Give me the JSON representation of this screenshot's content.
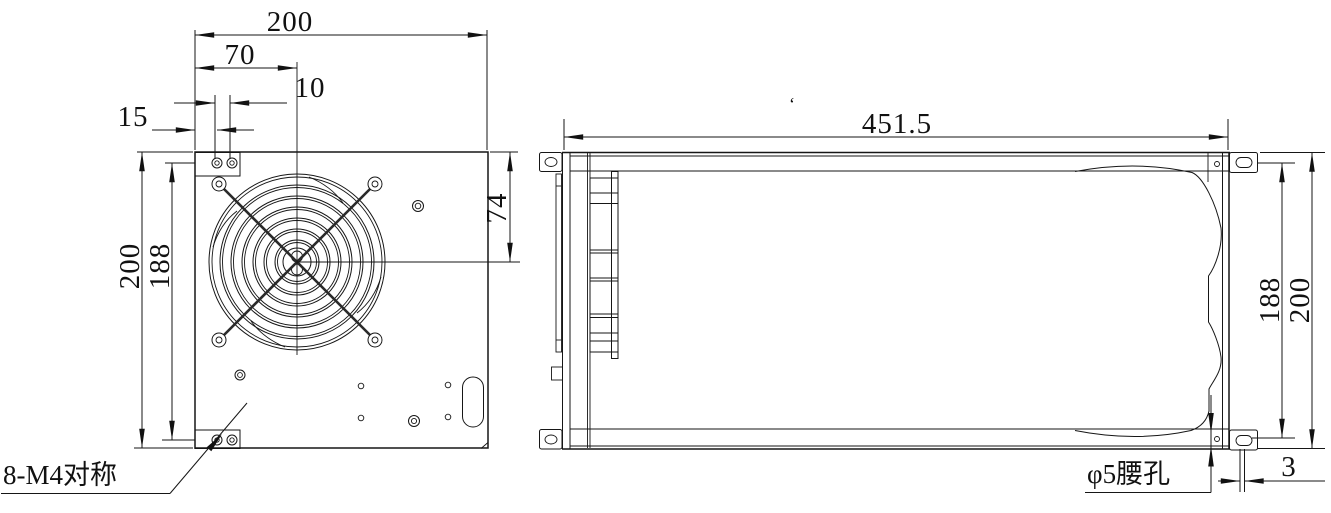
{
  "front_view": {
    "dim_total_width": "200",
    "dim_center_offset": "70",
    "dim_hole_pitch": "10",
    "dim_edge_to_hole": "15",
    "dim_total_height": "200",
    "dim_hole_span_vertical": "188",
    "dim_fan_center_from_top": "74",
    "label_mounting_holes": "8-M4对称"
  },
  "side_view": {
    "dim_total_length": "451.5",
    "dim_hole_span_vertical": "188",
    "dim_total_height": "200",
    "dim_slot_edge_offset": "3",
    "label_slot": "φ5腰孔",
    "stray_mark": "‘"
  }
}
